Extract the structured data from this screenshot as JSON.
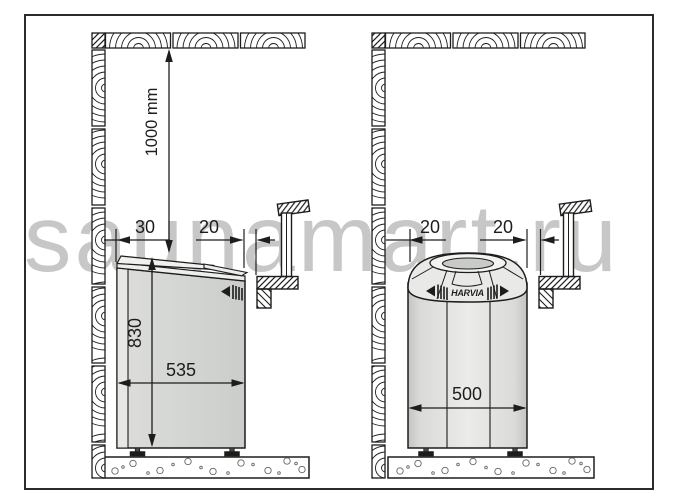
{
  "watermark": "saunamart.ru",
  "left_diagram": {
    "ceiling_clearance": "1000 mm",
    "wall_gap": "30",
    "front_gap": "20",
    "heater_height": "830",
    "heater_width": "535"
  },
  "right_diagram": {
    "wall_gap": "20",
    "front_gap": "20",
    "heater_width": "500",
    "brand_logo": "HARVIA"
  },
  "colors": {
    "line": "#1d1d1b",
    "heater_body": "#d4d6d4",
    "watermark": "#c7c7c7",
    "background": "#ffffff"
  }
}
